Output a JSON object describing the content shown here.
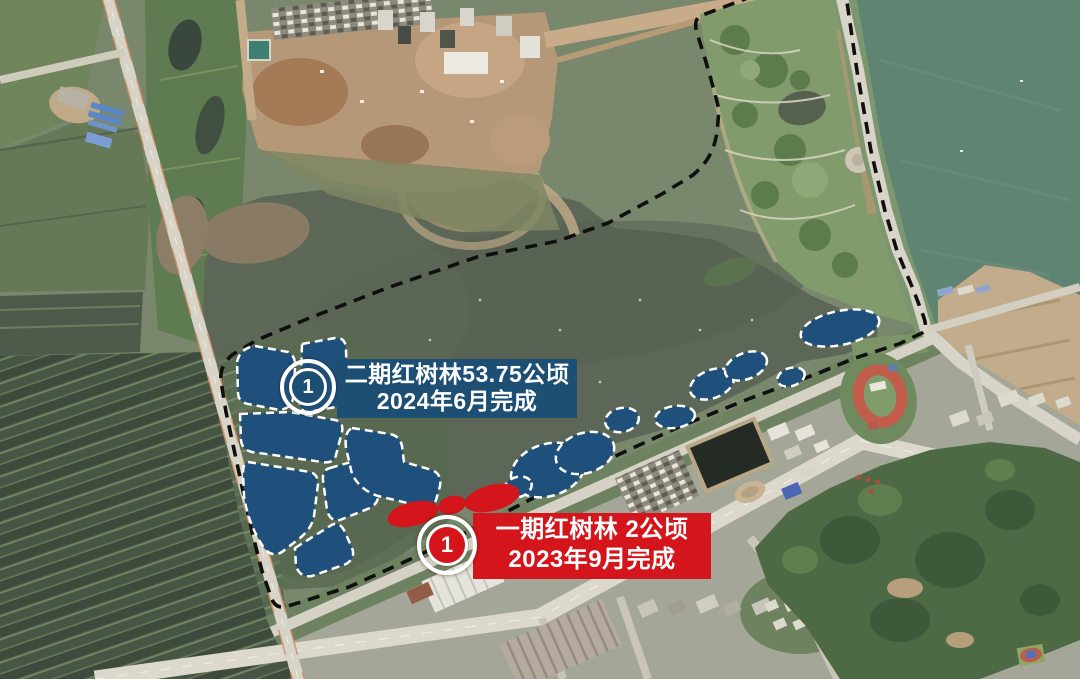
{
  "map_annotations": {
    "boundary": {
      "color": "#0f0f0f",
      "style": "black-dashed"
    },
    "phase2": {
      "marker_number": "1",
      "label_line1": "二期红树林53.75公顷",
      "label_line2": "2024年6月完成",
      "label_bg_color": "#1d4e74",
      "region_fill_color": "#1f4f7b",
      "region_outline": "white-dashed"
    },
    "phase1": {
      "marker_number": "1",
      "label_line1": "一期红树林 2公顷",
      "label_line2": "2023年9月完成",
      "label_bg_color": "#d4161c",
      "region_fill_color": "#d4161c"
    }
  }
}
